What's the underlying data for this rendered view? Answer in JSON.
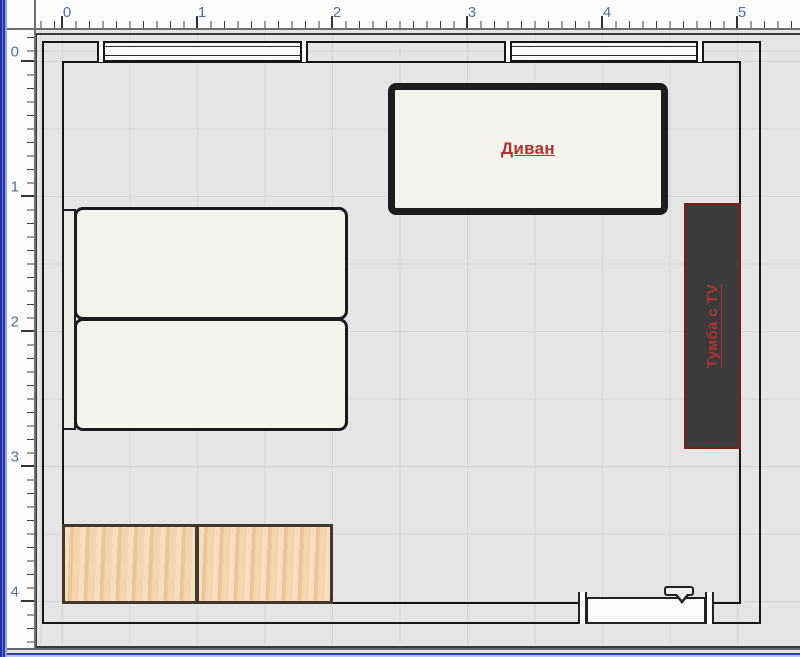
{
  "rulers": {
    "top": {
      "unit_labels": [
        "0",
        "1",
        "2",
        "3",
        "4",
        "5"
      ]
    },
    "left": {
      "unit_labels": [
        "0",
        "1",
        "2",
        "3",
        "4"
      ]
    }
  },
  "room": {
    "furniture": {
      "sofa": {
        "label": "Диван"
      },
      "tv_stand": {
        "label": "Тумба с TV"
      },
      "bed": {
        "label": ""
      },
      "cabinets": {
        "count": 2
      },
      "windows": {
        "count": 2
      },
      "radiator": {
        "label": ""
      }
    }
  },
  "icons": {
    "radiator_valve": "valve-handle-icon"
  },
  "colors": {
    "label_red": "#b03230",
    "wood": "#f3cc9e",
    "stand_dark": "#3b3b3b",
    "stand_border": "#7d1b1b",
    "wall_line": "#161616",
    "furniture_fill": "#f4f2ec",
    "canvas_bg": "#e5e5e5",
    "ruler_number_blue": "#4c72a2",
    "window_edge_blue": "#2b36a6"
  }
}
